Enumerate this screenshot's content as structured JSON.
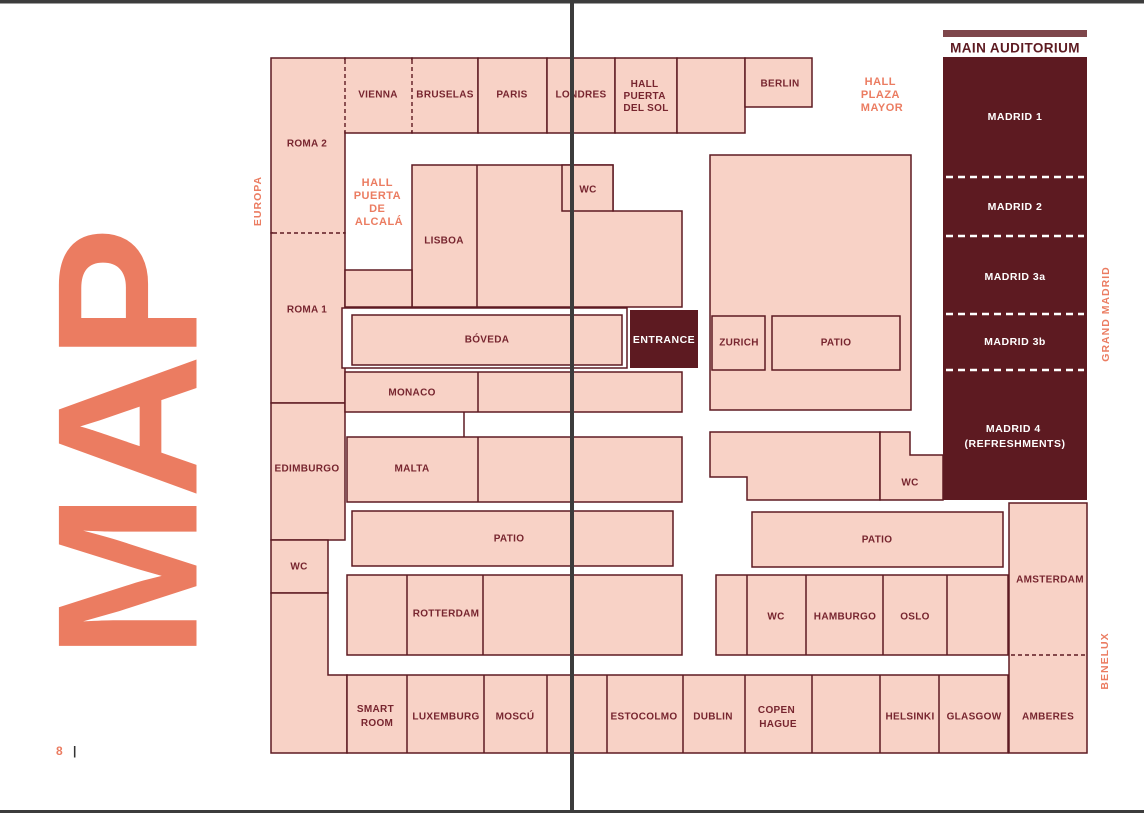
{
  "colors": {
    "room_fill": "#F8D2C6",
    "room_border": "#5E1A22",
    "dark_fill": "#5D1A21",
    "label_color": "#77252F",
    "coral": "#EB7C61",
    "fold_color": "#3C3C3C",
    "auditorium_bar": "#7E464B"
  },
  "page": {
    "number": "8",
    "separator": "|",
    "map_title": "MAP"
  },
  "side_labels": {
    "europa": "EUROPA",
    "grand_madrid": "GRAND MADRID",
    "benelux": "BENELUX"
  },
  "halls": {
    "puerta_de_alcala": [
      "HALL",
      "PUERTA",
      "DE",
      "ALCALÁ"
    ],
    "plaza_mayor": [
      "HALL",
      "PLAZA",
      "MAYOR"
    ],
    "puerta_del_sol": [
      "HALL",
      "PUERTA",
      "DEL SOL"
    ]
  },
  "auditorium": {
    "title": "MAIN AUDITORIUM",
    "madrid1": "MADRID 1",
    "madrid2": "MADRID 2",
    "madrid3a": "MADRID 3a",
    "madrid3b": "MADRID 3b",
    "madrid4": [
      "MADRID 4",
      "(REFRESHMENTS)"
    ]
  },
  "rooms": {
    "roma2": "ROMA 2",
    "roma1": "ROMA 1",
    "edimburgo": "EDIMBURGO",
    "wc": "WC",
    "vienna": "VIENNA",
    "bruselas": "BRUSELAS",
    "paris": "PARIS",
    "londres": "LONDRES",
    "berlin": "BERLIN",
    "lisboa": "LISBOA",
    "boveda": "BÓVEDA",
    "entrance": "ENTRANCE",
    "zurich": "ZURICH",
    "patio": "PATIO",
    "monaco": "MONACO",
    "malta": "MALTA",
    "rotterdam": "ROTTERDAM",
    "smart_room": [
      "SMART",
      "ROOM"
    ],
    "luxemburg": "LUXEMBURG",
    "moscu": "MOSCÚ",
    "estocolmo": "ESTOCOLMO",
    "dublin": "DUBLIN",
    "copenhague": [
      "COPEN",
      "HAGUE"
    ],
    "helsinki": "HELSINKI",
    "glasgow": "GLASGOW",
    "amberes": "AMBERES",
    "hamburgo": "HAMBURGO",
    "oslo": "OSLO",
    "amsterdam": "AMSTERDAM"
  }
}
